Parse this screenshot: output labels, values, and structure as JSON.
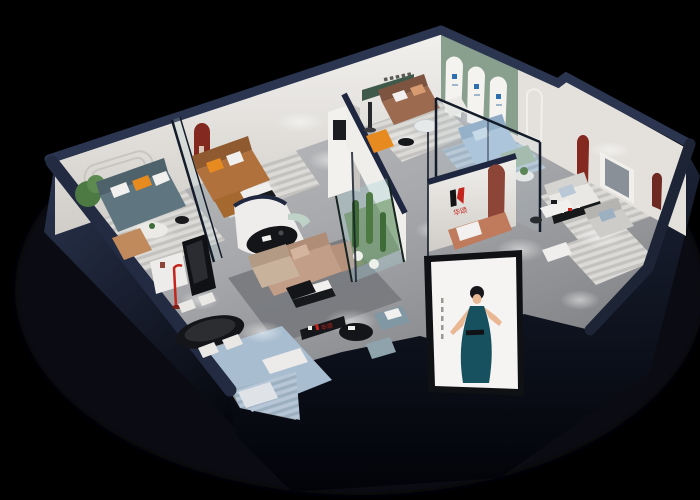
{
  "scene": {
    "kind": "3D isometric cutaway render of a furniture showroom",
    "background": "#000000"
  },
  "brand": {
    "logo_text": "华颂"
  },
  "palette": {
    "background": "#000000",
    "shadow": "#0b0e16",
    "outer_wall": "#27314a",
    "outer_wall_dark": "#10151f",
    "wall_cap": "#252e48",
    "wall_face": "#edebe7",
    "wall_face_shade": "#d3d0cb",
    "floor_light": "#c7c8ca",
    "floor_dark": "#8e9093",
    "sage_wall": "#8aa08e",
    "green_niche": "#3f5a4b",
    "maroon_niche": "#84291f",
    "accent_red": "#c3251d",
    "accent_orange": "#e78a1f",
    "caramel_sofa": "#b0713d",
    "brown_sofa": "#9c6b4f",
    "tan_sofa": "#c29d87",
    "teal_sofa": "#5f7580",
    "blue_sofa": "#a9c3da",
    "sage_seat": "#9fb8a6",
    "mint_seat": "#bed2c8",
    "rug_blue": "#a8bdd0",
    "rug_light": "#d9d8d5",
    "furniture_black": "#141518",
    "furniture_white": "#f0efec",
    "glass": "#a9cdd4",
    "plant_green": "#4c7a42",
    "poster_bg": "#f5f4f2",
    "poster_dress": "#17505f",
    "poster_skin": "#eab793",
    "poster_hair": "#17171b"
  }
}
